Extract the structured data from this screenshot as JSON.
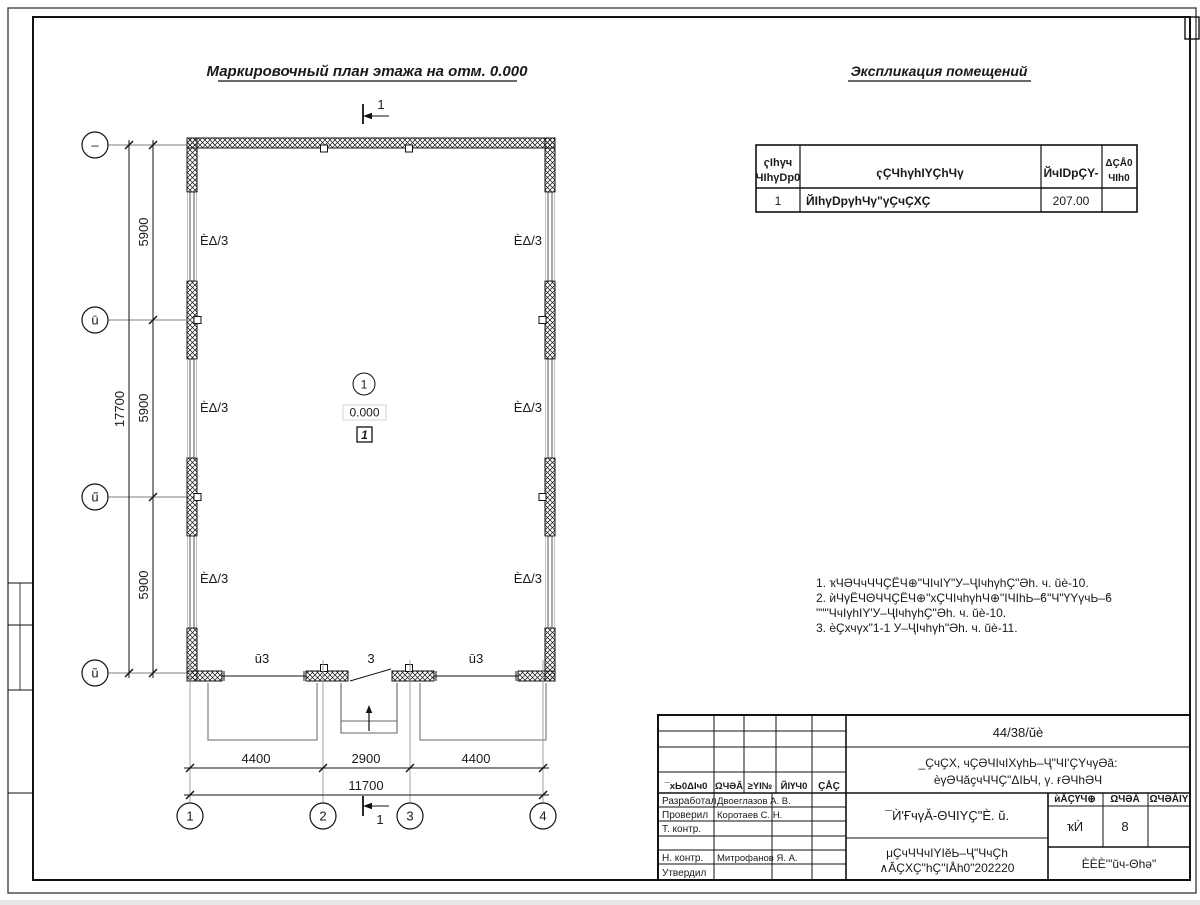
{
  "titles": {
    "plan_title": "Маркировочный план этажа на отм. 0.000",
    "explication_title": "Экспликация помещений"
  },
  "explication_table": {
    "header": {
      "col1_line1": "ҁIhγч",
      "col1_line2": "ЧIhγDp0",
      "col2": "ҁҪЧhγhIYҪhЧγ",
      "col3": "ЙчIDpҪY-",
      "col4_line1": "ΔҪÅ0",
      "col4_line2": "ЧIh0"
    },
    "row": {
      "num": "1",
      "name": "ЙIhγDpγhЧγ\"γҪчҪХҪ",
      "area": "207.00",
      "category": ""
    }
  },
  "notes": {
    "line1": "1. ҡЧӘЧчЧЧҪЁЧ⊕\"ЧIчIY\"У–ҶIчhγhҪ\"Әh. ч. ŭè-10.",
    "line2": "2. ѝЧγЁЧΘЧЧҪЁЧ⊕\"хҪЧIчhγhЧ⊕\"IЧIhЬ–ϐ\"Ч\"ҮYγчЬ–ϐ",
    "line3": "\"\"\"ЧчIγhIY'У–ҶIчhγhҪ\"Әh. ч. ŭè-10.",
    "line4": "3. ѐҪхчγх\"1-1 У–ҶIчhγh\"Әh. ч. ŭè-11."
  },
  "plan": {
    "wall_label": "ÈΔ/3",
    "gate_label": "ū3",
    "door_label": "3",
    "room_number": "1",
    "elevation": "0.000",
    "room_category": "1",
    "section_mark": "1"
  },
  "axes": {
    "h1": "1",
    "h2": "2",
    "h3": "3",
    "h4": "4",
    "v1": "–",
    "v2": "ū",
    "v3": "ű",
    "v4": "ŭ"
  },
  "dimensions": {
    "bay1": "4400",
    "bay2": "2900",
    "bay3": "4400",
    "h_total": "11700",
    "vbay1": "5900",
    "vbay2": "5900",
    "vbay3": "5900",
    "v_total": "17700"
  },
  "title_block": {
    "project_code": "44/38/ŭè",
    "object_line1": "_ҪчҪХ, чҪӘЧIчIХγhЬ–Ҷ\"ЧI'ҪYчγӘă:",
    "object_line2": "ѐγӘЧăҫчЧЧҪ\"ΔIЬЧ, γ. ғӘЧhӘЧ",
    "sheet_title": "¯Ѝ'ҒчγǍ-ΘЧIYҪ\"È. ŭ.",
    "doc_line1": "μҪчЧЧчIYIĕЬ–Ҷ\"ЧчҪh",
    "doc_line2": "∧ĂҪХҪ\"hҪ\"IÅh0\"202220",
    "col1": "¯хЬ0ΔIч0",
    "col2": "ΩЧӘĂ",
    "col3": "≥YI№",
    "col4": "ЙIҮЧ0",
    "col5": "ҪÅҪ",
    "row1_role": "Разработал",
    "row1_name": "Двоеглазов А. В.",
    "row2_role": "Проверил",
    "row2_name": "Коротаев С. Н.",
    "row3_role": "Т. контр.",
    "row3_name": "",
    "row4_role": "",
    "row4_name": "",
    "row5_role": "Н. контр.",
    "row5_name": "Митрофанов Я. А.",
    "row6_role": "Утвердил",
    "row6_name": "",
    "stage_h1": "ѝÅҪҮЧ⊕",
    "stage_h2": "ΩЧӘĂ",
    "stage_h3": "ΩЧӘĂIY",
    "stage_v1": "ҡЍ",
    "sheet_num": "8",
    "sheets_total": "",
    "company": "ÈÈÈ'\"ŭч-Θhә\""
  }
}
